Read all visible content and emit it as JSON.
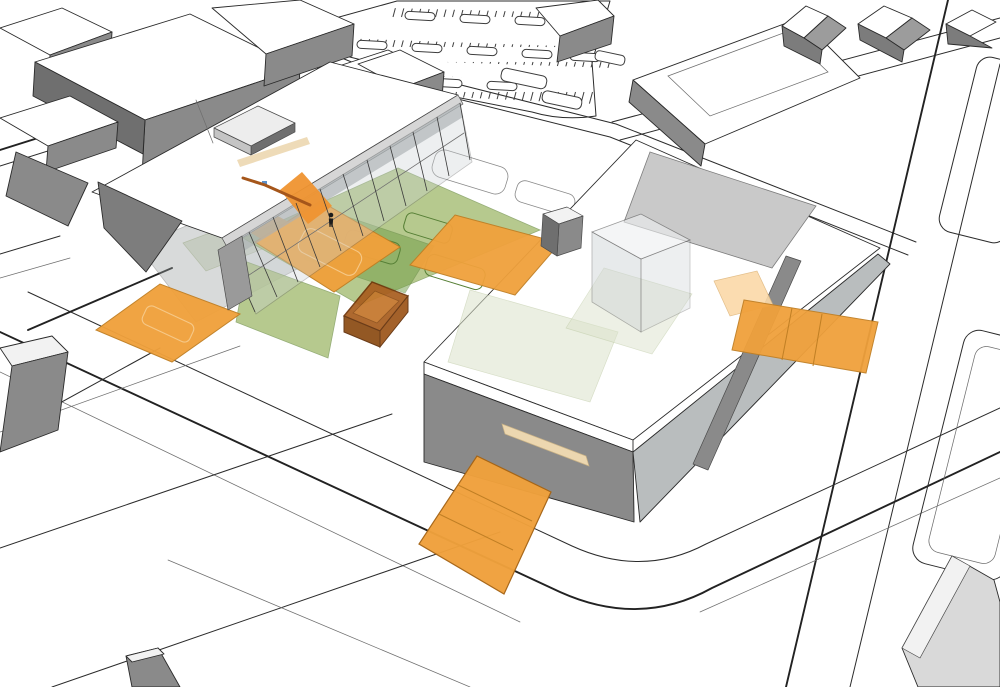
{
  "meta": {
    "description": "axonometric-site-massing-diagram",
    "width": 1000,
    "height": 687
  },
  "scene": {
    "background": "#ffffff",
    "line": "#2b2b2b",
    "colors": {
      "roof_white": "#ffffff",
      "roof_shade": "#f2f2f2",
      "fascia": "#d6d6d6",
      "wall": "#8a8a8a",
      "wall_dark": "#6f6f6f",
      "wall_light": "#b9bdbe",
      "wall_wedge": "#7d7d7d",
      "slope_roof": "#c9c9c9",
      "glass": "#ccd2d5",
      "glass_dark": "#9aa0a2",
      "canopy": "#9aa0a0",
      "orange": "#f0a13c",
      "orange_light": "#fbd9a8",
      "orange_interior": "#ef9430",
      "orange_edge": "#c07f24",
      "box_rim": "#9c5418",
      "box_floor": "#c4762b",
      "box_front": "#8a4a12",
      "box_side": "#a85d1e",
      "green": "#a4bc72",
      "green_dark": "#6f9c45",
      "green_edge": "#7d9b57",
      "green_pale": "#dce3cc",
      "pale_edge": "#b7c49b",
      "tan": "#ecd7b0",
      "person": "#1c1c1c",
      "blue": "#5b8fc9",
      "house_gray": "#9c9c9c",
      "house_body": "#7c7c7c",
      "light_mass": "#d9d9d9"
    },
    "elements": [
      "street-network",
      "parking-lot",
      "context-buildings",
      "residential-houses",
      "anchor-building",
      "bar-building",
      "east-building",
      "orange-plaza",
      "orange-entry-planes",
      "green-landscape-zones",
      "sunken-court-box",
      "glass-cube",
      "gray-cube",
      "scale-figure"
    ]
  }
}
